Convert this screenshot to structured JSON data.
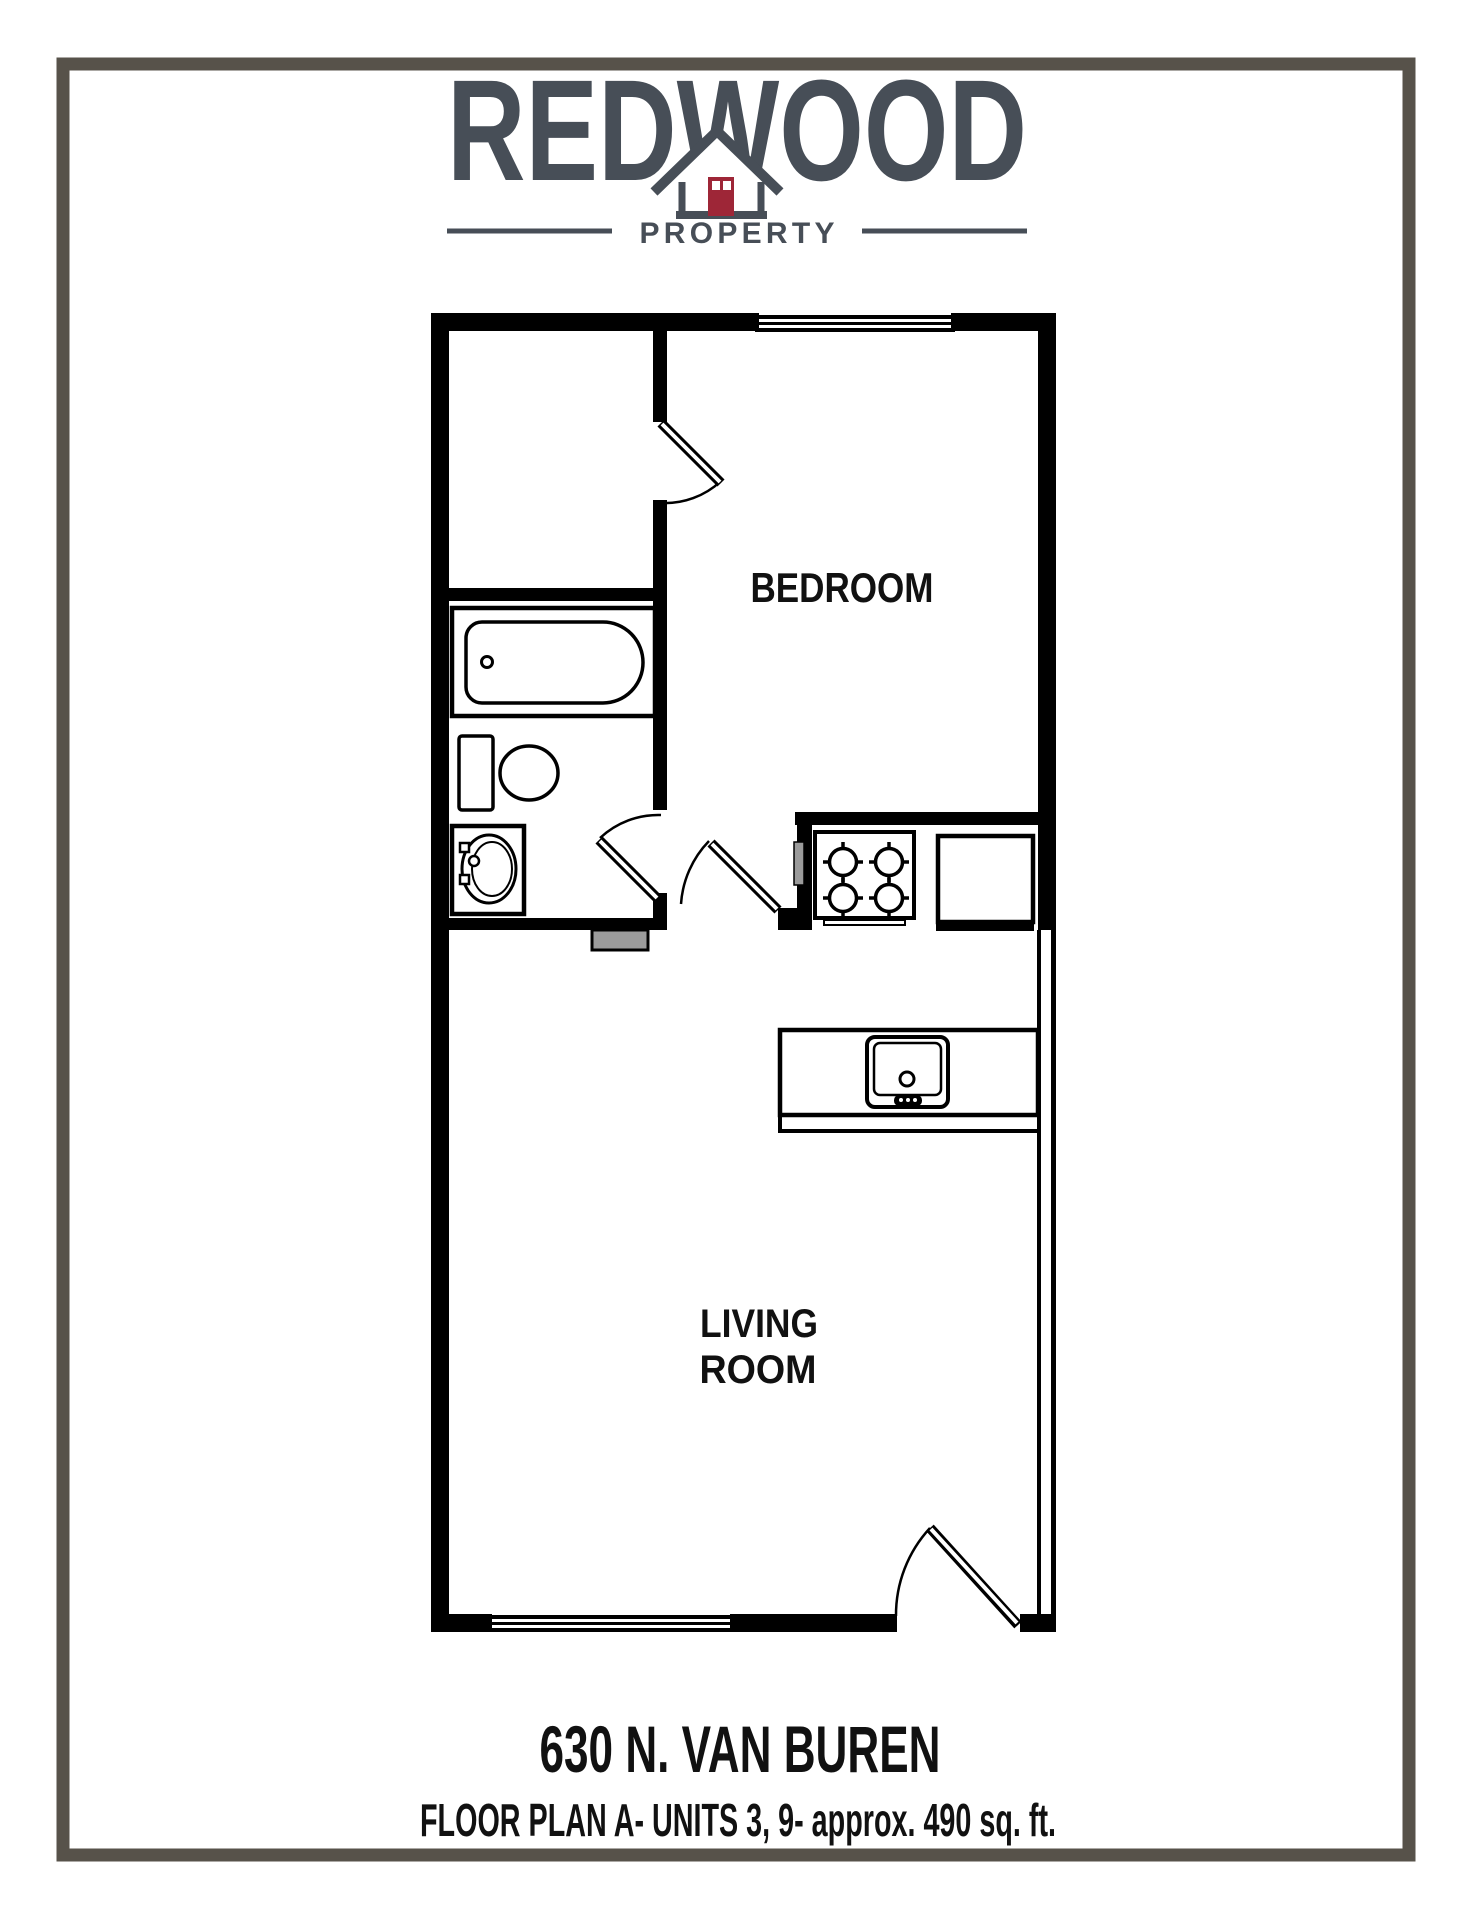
{
  "page": {
    "border_color": "#57524a",
    "background": "#ffffff"
  },
  "logo": {
    "brand": "REDWOOD",
    "tagline": "PROPERTY",
    "text_color": "#474e57",
    "door_color": "#9e2637",
    "icon": "house-icon"
  },
  "floor_plan": {
    "line_color": "#000000",
    "threshold_color": "#9b9b9b",
    "rooms": {
      "bedroom_label": "BEDROOM",
      "living_room_label_line1": "LIVING",
      "living_room_label_line2": "ROOM"
    },
    "fixtures": [
      "bathtub",
      "toilet",
      "bathroom-sink",
      "stove",
      "refrigerator",
      "kitchen-sink"
    ],
    "doors": [
      "closet-door",
      "bathroom-door",
      "bedroom-door",
      "entry-door"
    ],
    "windows": [
      "bedroom-window",
      "living-room-window"
    ]
  },
  "footer": {
    "address": "630 N. VAN BUREN",
    "plan_details": "FLOOR PLAN A- UNITS 3, 9- approx. 490 sq. ft."
  }
}
